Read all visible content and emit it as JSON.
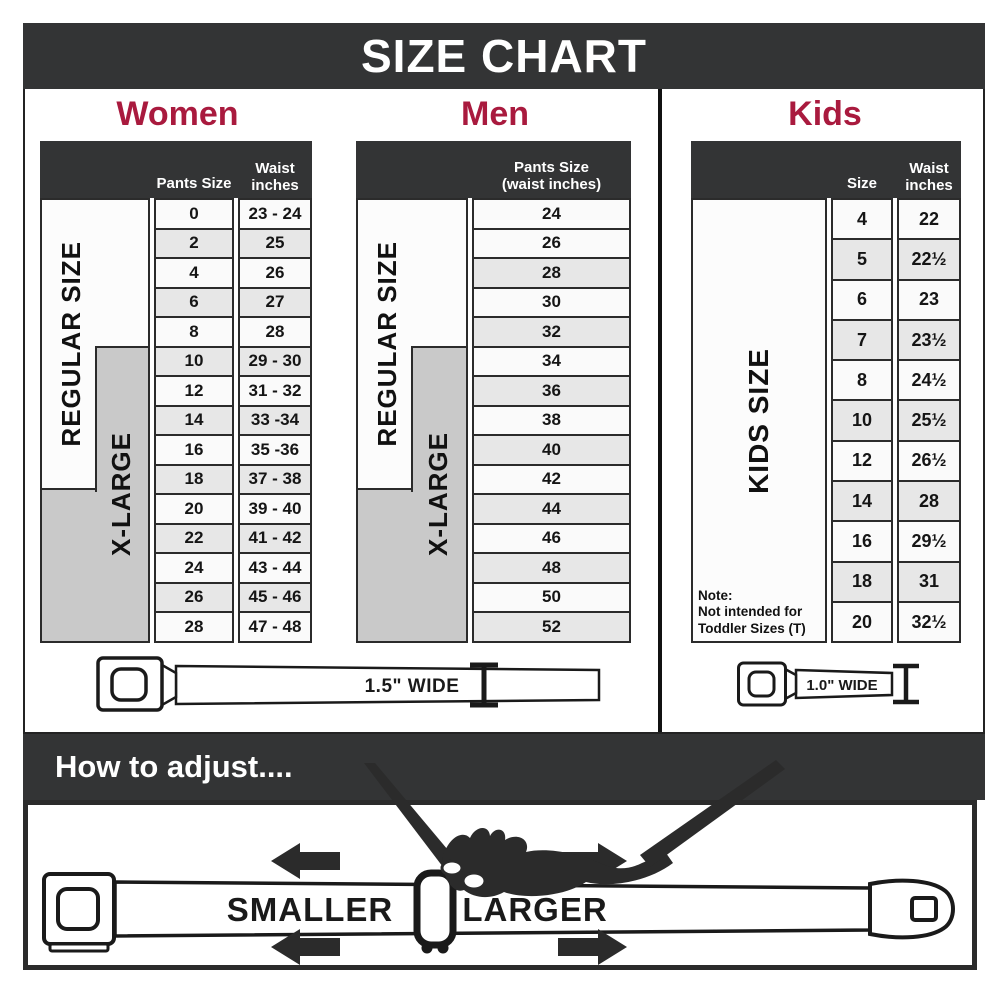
{
  "title": "SIZE CHART",
  "colors": {
    "accent_red": "#A91A3E",
    "banner_dark": "#333435",
    "xlarge_gray": "#C9C9C9",
    "row_alt_gray": "#E7E7E7"
  },
  "women": {
    "heading": "Women",
    "header": {
      "pants_size": "Pants Size",
      "waist_line1": "Waist",
      "waist_line2": "inches"
    },
    "regular_label": "REGULAR SIZE",
    "xlarge_label": "X-LARGE",
    "rows": [
      {
        "size": "0",
        "waist": "23 - 24"
      },
      {
        "size": "2",
        "waist": "25"
      },
      {
        "size": "4",
        "waist": "26"
      },
      {
        "size": "6",
        "waist": "27"
      },
      {
        "size": "8",
        "waist": "28"
      },
      {
        "size": "10",
        "waist": "29 - 30"
      },
      {
        "size": "12",
        "waist": "31 - 32"
      },
      {
        "size": "14",
        "waist": "33 -34"
      },
      {
        "size": "16",
        "waist": "35 -36"
      },
      {
        "size": "18",
        "waist": "37 - 38"
      },
      {
        "size": "20",
        "waist": "39 - 40"
      },
      {
        "size": "22",
        "waist": "41 - 42"
      },
      {
        "size": "24",
        "waist": "43 - 44"
      },
      {
        "size": "26",
        "waist": "45 - 46"
      },
      {
        "size": "28",
        "waist": "47 - 48"
      }
    ],
    "belt_label": "1.5\" WIDE"
  },
  "men": {
    "heading": "Men",
    "header": {
      "line1": "Pants Size",
      "line2": "(waist inches)"
    },
    "regular_label": "REGULAR SIZE",
    "xlarge_label": "X-LARGE",
    "rows": [
      "24",
      "26",
      "28",
      "30",
      "32",
      "34",
      "36",
      "38",
      "40",
      "42",
      "44",
      "46",
      "48",
      "50",
      "52"
    ]
  },
  "kids": {
    "heading": "Kids",
    "header": {
      "size": "Size",
      "waist_line1": "Waist",
      "waist_line2": "inches"
    },
    "side_label": "KIDS SIZE",
    "note": {
      "line1": "Note:",
      "line2": "Not intended for",
      "line3": "Toddler Sizes (T)"
    },
    "rows": [
      {
        "size": "4",
        "waist": "22"
      },
      {
        "size": "5",
        "waist": "22½"
      },
      {
        "size": "6",
        "waist": "23"
      },
      {
        "size": "7",
        "waist": "23½"
      },
      {
        "size": "8",
        "waist": "24½"
      },
      {
        "size": "10",
        "waist": "25½"
      },
      {
        "size": "12",
        "waist": "26½"
      },
      {
        "size": "14",
        "waist": "28"
      },
      {
        "size": "16",
        "waist": "29½"
      },
      {
        "size": "18",
        "waist": "31"
      },
      {
        "size": "20",
        "waist": "32½"
      }
    ],
    "belt_label": "1.0\" WIDE"
  },
  "adjust": {
    "heading": "How to adjust....",
    "smaller_label": "SMALLER",
    "larger_label": "LARGER"
  }
}
